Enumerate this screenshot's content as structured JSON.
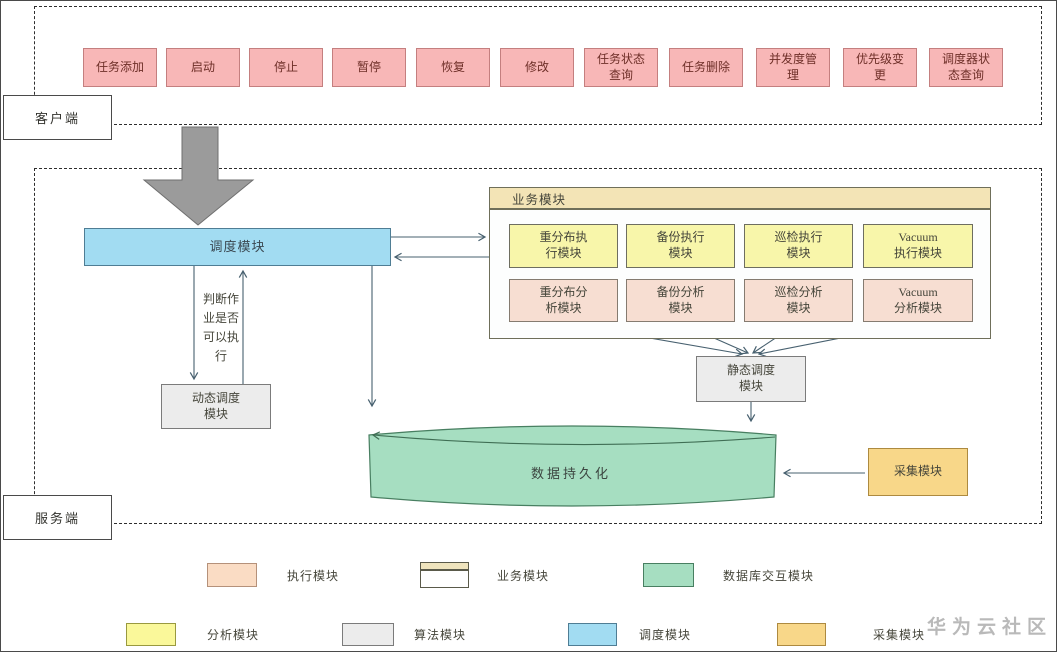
{
  "diagram_title": "任务调度器架构图",
  "client": {
    "label": "客户端",
    "buttons": [
      {
        "label": "任务添加"
      },
      {
        "label": "启动"
      },
      {
        "label": "停止"
      },
      {
        "label": "暂停"
      },
      {
        "label": "恢复"
      },
      {
        "label": "修改"
      },
      {
        "label": "任务状态\n查询"
      },
      {
        "label": "任务删除"
      },
      {
        "label": "并发度管\n理"
      },
      {
        "label": "优先级变\n更"
      },
      {
        "label": "调度器状\n态查询"
      }
    ]
  },
  "server": {
    "label": "服务端",
    "scheduler": {
      "label": "调度模块"
    },
    "decision_note": "判断作\n业是否\n可以执\n行",
    "dynamic_scheduler": {
      "label": "动态调度\n模块"
    },
    "static_scheduler": {
      "label": "静态调度\n模块"
    },
    "business": {
      "title": "业务模块",
      "exec_modules": [
        "重分布执\n行模块",
        "备份执行\n模块",
        "巡检执行\n模块",
        "Vacuum\n执行模块"
      ],
      "analysis_modules": [
        "重分布分\n析模块",
        "备份分析\n模块",
        "巡检分析\n模块",
        "Vacuum\n分析模块"
      ]
    },
    "persistence": {
      "label": "数据持久化"
    },
    "collector": {
      "label": "采集模块"
    }
  },
  "legend": {
    "items": [
      {
        "label": "执行模块",
        "swatch": "peach"
      },
      {
        "label": "业务模块",
        "swatch": "business-header"
      },
      {
        "label": "数据库交互模块",
        "swatch": "green"
      },
      {
        "label": "分析模块",
        "swatch": "yellow"
      },
      {
        "label": "算法模块",
        "swatch": "gray"
      },
      {
        "label": "调度模块",
        "swatch": "blue"
      },
      {
        "label": "采集模块",
        "swatch": "orange"
      }
    ]
  },
  "watermark": "华为云社区",
  "colors": {
    "client_button_fill": "#f8b7b7",
    "scheduler_blue": "#a2dcf2",
    "exec_yellow": "#f8f6aa",
    "analysis_peach": "#f7ded2",
    "algorithm_gray": "#ececec",
    "business_header_tan": "#f3e4b6",
    "database_green": "#a6dec1",
    "collector_orange": "#f8d789",
    "connector_line": "#47606f",
    "big_arrow_gray": "#9b9b9b"
  }
}
